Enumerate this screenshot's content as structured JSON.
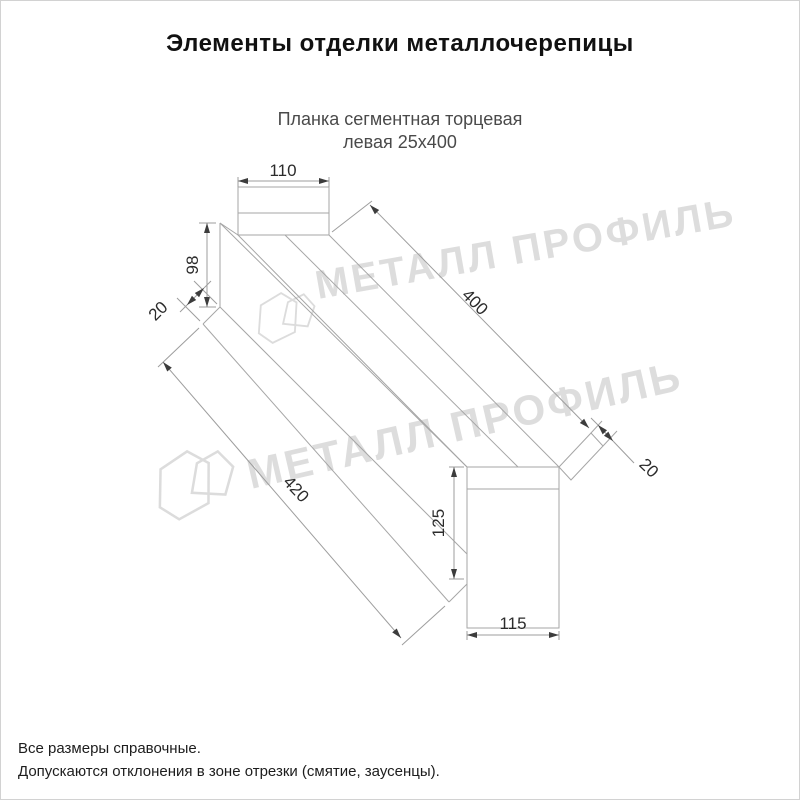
{
  "title": "Элементы отделки металлочерепицы",
  "subtitle": {
    "line1": "Планка сегментная торцевая",
    "line2": "левая 25х400"
  },
  "watermark": {
    "text": "МЕТАЛЛ ПРОФИЛЬ"
  },
  "drawing": {
    "part_name": "Планка сегментная торцевая левая 25х400",
    "dimensions": {
      "top_width": "110",
      "left_height": "98",
      "left_flange": "20",
      "length_top": "400",
      "length_bottom": "420",
      "right_flange": "20",
      "bottom_height": "125",
      "bottom_width": "115"
    }
  },
  "footnotes": [
    "Все размеры справочные.",
    "Допускаются отклонения в зоне отрезки (смятие, заусенцы)."
  ],
  "colors": {
    "line_gray": "#a6a6a6",
    "dim_text": "#2b2b2b",
    "arrow": "#3c3c3c",
    "watermark": "#ababab",
    "title_text": "#111111",
    "subtitle_text": "#4a4a4a"
  }
}
